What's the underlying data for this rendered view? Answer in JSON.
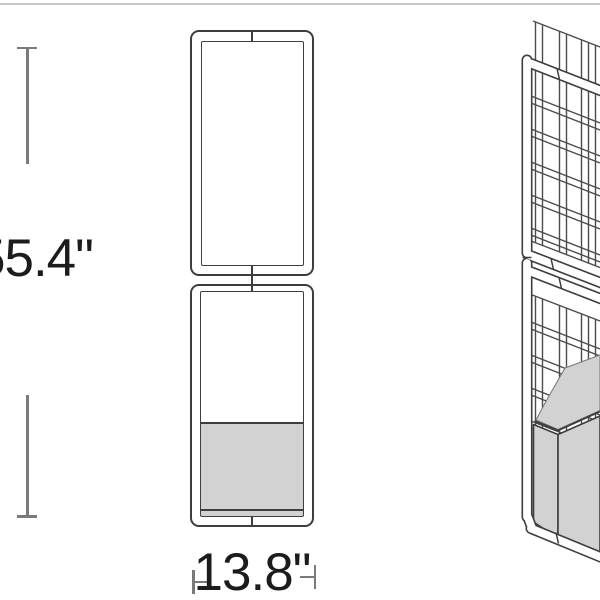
{
  "dimensions": {
    "height_label": "55.4\"",
    "width_label": "13.8\""
  },
  "styles": {
    "outline_color": "#3e3e3e",
    "dimension_line_color": "#7a7a7a",
    "label_color": "#1c1c1c",
    "planter_fill": "#d2d2d2"
  },
  "views": {
    "front": "front-elevation-two-stacked-frames-with-planter",
    "perspective": "perspective-lattice-trellis-with-planter-box"
  }
}
